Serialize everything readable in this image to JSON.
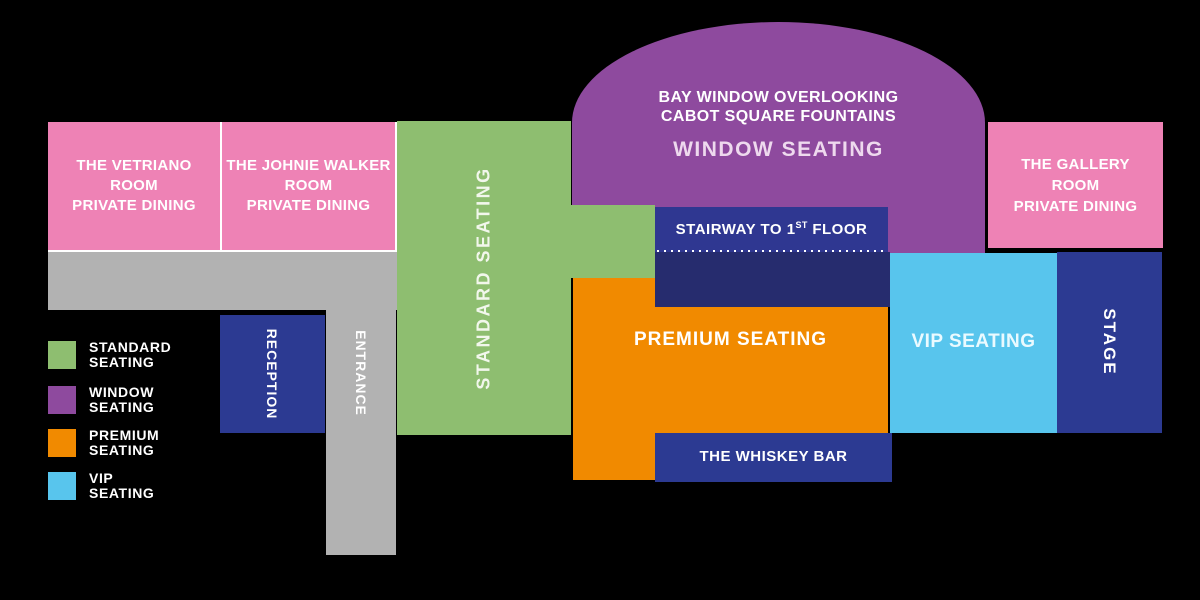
{
  "palette": {
    "background": "#000000",
    "pink": "#ee82b5",
    "green": "#8ebe70",
    "purple": "#8e4a9e",
    "orange": "#f18a00",
    "blue": "#58c5ed",
    "navy": "#2c3a92",
    "navy_light": "#2f3791",
    "navy_dark": "#262c6e",
    "gray": "#b2b2b2"
  },
  "map": {
    "private_rooms": {
      "vetriano": {
        "line1": "THE VETRIANO",
        "line2": "ROOM",
        "line3": "PRIVATE DINING"
      },
      "johnie_walker": {
        "line1": "THE JOHNIE WALKER",
        "line2": "ROOM",
        "line3": "PRIVATE DINING"
      },
      "gallery": {
        "line1": "THE GALLERY",
        "line2": "ROOM",
        "line3": "PRIVATE DINING"
      }
    },
    "standard_seating": {
      "label": "STANDARD SEATING"
    },
    "window_seating": {
      "line1": "BAY WINDOW OVERLOOKING",
      "line2": "CABOT SQUARE FOUNTAINS",
      "label": "WINDOW SEATING"
    },
    "stairway": {
      "prefix": "STAIRWAY TO 1",
      "superscript": "ST",
      "suffix": " FLOOR"
    },
    "premium_seating": {
      "label": "PREMIUM SEATING"
    },
    "vip_seating": {
      "label": "VIP SEATING"
    },
    "stage": {
      "label": "STAGE"
    },
    "whiskey_bar": {
      "label": "THE WHISKEY BAR"
    },
    "reception": {
      "label": "RECEPTION"
    },
    "entrance": {
      "label": "ENTRANCE"
    }
  },
  "legend": {
    "items": [
      {
        "line1": "STANDARD",
        "line2": "SEATING",
        "color": "#8ebe70"
      },
      {
        "line1": "WINDOW",
        "line2": "SEATING",
        "color": "#8e4a9e"
      },
      {
        "line1": "PREMIUM",
        "line2": "SEATING",
        "color": "#f18a00"
      },
      {
        "line1": "VIP",
        "line2": "SEATING",
        "color": "#58c5ed"
      }
    ]
  }
}
